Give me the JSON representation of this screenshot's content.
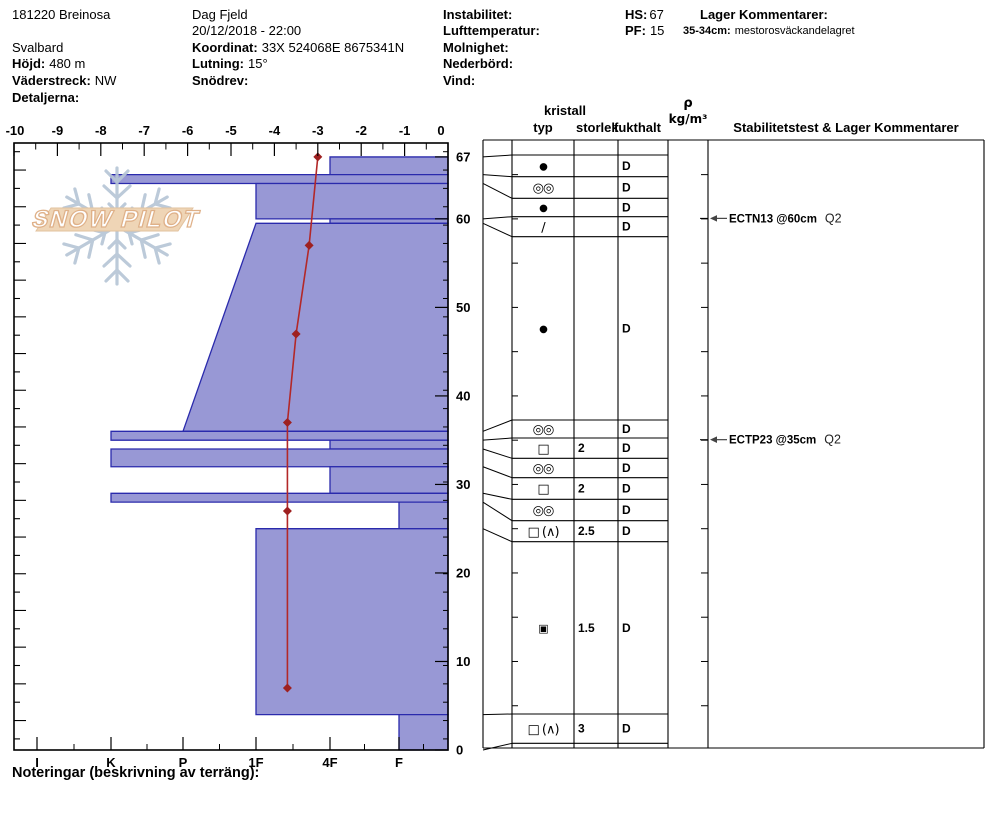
{
  "header": {
    "pit_id": "181220 Breinosa",
    "region": "Svalbard",
    "hojd_label": "Höjd:",
    "hojd_value": "480 m",
    "vaderstreck_label": "Väderstreck:",
    "vaderstreck_value": "NW",
    "detaljerna_label": "Detaljerna:",
    "observer": "Dag Fjeld",
    "datetime": "20/12/2018 - 22:00",
    "koordinat_label": "Koordinat:",
    "koordinat_value": "33X 524068E 8675341N",
    "lutning_label": "Lutning:",
    "lutning_value": "15°",
    "snodrev_label": "Snödrev:",
    "instabilitet_label": "Instabilitet:",
    "lufttemperatur_label": "Lufttemperatur:",
    "molnighet_label": "Molnighet:",
    "nederbord_label": "Nederbörd:",
    "vind_label": "Vind:",
    "hs_label": "HS:",
    "hs_value": "67",
    "pf_label": "PF:",
    "pf_value": "15",
    "lager_kommentarer_label": "Lager Kommentarer:",
    "layer_comment_key": "35-34cm:",
    "layer_comment_value": "mestorosväckandelagret"
  },
  "logo": {
    "text": "SNOW PILOT"
  },
  "chart_data": {
    "type": "area",
    "title": "Snow pit profile (hardness bars + temperature line)",
    "temp_axis": {
      "min": -10,
      "max": 0,
      "tick_step": 1,
      "minor_step": 0.5
    },
    "depth_axis": {
      "min": 0,
      "max": 67,
      "labels": [
        67,
        60,
        50,
        40,
        30,
        20,
        10,
        0
      ]
    },
    "hardness_axis": {
      "labels": [
        "I",
        "K",
        "P",
        "1F",
        "4F",
        "F"
      ]
    },
    "layers": [
      {
        "top": 67,
        "bottom": 65,
        "hardness": "4F"
      },
      {
        "top": 65,
        "bottom": 64,
        "hardness": "K"
      },
      {
        "top": 64,
        "bottom": 60,
        "hardness": "1F"
      },
      {
        "top": 60,
        "bottom": 59.5,
        "hardness": "4F"
      },
      {
        "top": 59.5,
        "bottom": 36,
        "hardness_top": "1F",
        "hardness_bottom": "P"
      },
      {
        "top": 36,
        "bottom": 35,
        "hardness": "K"
      },
      {
        "top": 35,
        "bottom": 34,
        "hardness": "4F"
      },
      {
        "top": 34,
        "bottom": 32,
        "hardness": "K"
      },
      {
        "top": 32,
        "bottom": 29,
        "hardness": "4F"
      },
      {
        "top": 29,
        "bottom": 28,
        "hardness": "K"
      },
      {
        "top": 28,
        "bottom": 25,
        "hardness": "F"
      },
      {
        "top": 25,
        "bottom": 4,
        "hardness": "1F"
      },
      {
        "top": 4,
        "bottom": 0,
        "hardness": "F"
      }
    ],
    "temperature_profile": [
      {
        "depth": 67,
        "temp": -3.0
      },
      {
        "depth": 57,
        "temp": -3.2
      },
      {
        "depth": 47,
        "temp": -3.5
      },
      {
        "depth": 37,
        "temp": -3.7
      },
      {
        "depth": 27,
        "temp": -3.7
      },
      {
        "depth": 7,
        "temp": -3.7
      }
    ],
    "tests": [
      {
        "name": "ECTN13 @60cm",
        "score": "Q2",
        "depth": 60
      },
      {
        "name": "ECTP23 @35cm",
        "score": "Q2",
        "depth": 35
      }
    ]
  },
  "table": {
    "headers": {
      "kristall": "kristall",
      "typ": "typ",
      "storlek": "storlek",
      "fukthalt": "fukthalt",
      "rho": "ρ",
      "rho_unit": "kg/m³",
      "stability": "Stabilitetstest & Lager Kommentarer"
    },
    "rows": [
      {
        "typ": "●",
        "typ_name": "rounded-grains",
        "storlek": "",
        "fukthalt": "D"
      },
      {
        "typ": "◎◎",
        "typ_name": "melt-freeze-crust-grains",
        "storlek": "",
        "fukthalt": "D"
      },
      {
        "typ": "●",
        "typ_name": "rounded-grains",
        "storlek": "",
        "fukthalt": "D"
      },
      {
        "typ": "∕",
        "typ_name": "decomposing-fragments",
        "storlek": "",
        "fukthalt": "D"
      },
      {
        "typ": "●",
        "typ_name": "rounded-grains",
        "storlek": "",
        "fukthalt": "D"
      },
      {
        "typ": "◎◎",
        "typ_name": "melt-freeze-crust-grains",
        "storlek": "",
        "fukthalt": "D"
      },
      {
        "typ": "□",
        "typ_name": "faceted-crystals",
        "storlek": "2",
        "fukthalt": "D"
      },
      {
        "typ": "◎◎",
        "typ_name": "melt-freeze-crust-grains",
        "storlek": "",
        "fukthalt": "D"
      },
      {
        "typ": "□",
        "typ_name": "faceted-crystals",
        "storlek": "2",
        "fukthalt": "D"
      },
      {
        "typ": "◎◎",
        "typ_name": "melt-freeze-crust-grains",
        "storlek": "",
        "fukthalt": "D"
      },
      {
        "typ": "□ (∧)",
        "typ_name": "facets-depth-hoar",
        "storlek": "2.5",
        "fukthalt": "D"
      },
      {
        "typ": "▣",
        "typ_name": "mixed-forms",
        "storlek": "1.5",
        "fukthalt": "D"
      },
      {
        "typ": "□ (∧)",
        "typ_name": "facets-depth-hoar",
        "storlek": "3",
        "fukthalt": "D"
      }
    ]
  },
  "footer": {
    "notes_label": "Noteringar (beskrivning av terräng):"
  },
  "colors": {
    "bar_fill": "#9898d5",
    "bar_border": "#2a2aac",
    "temp_line": "#b32828",
    "temp_marker": "#9e2020",
    "logo_snowflake": "#b7c6d6",
    "logo_banner": "#eed2b0",
    "logo_banner_border": "#e0bd96",
    "logo_text_outline": "#ddab80",
    "grid": "#000000"
  }
}
